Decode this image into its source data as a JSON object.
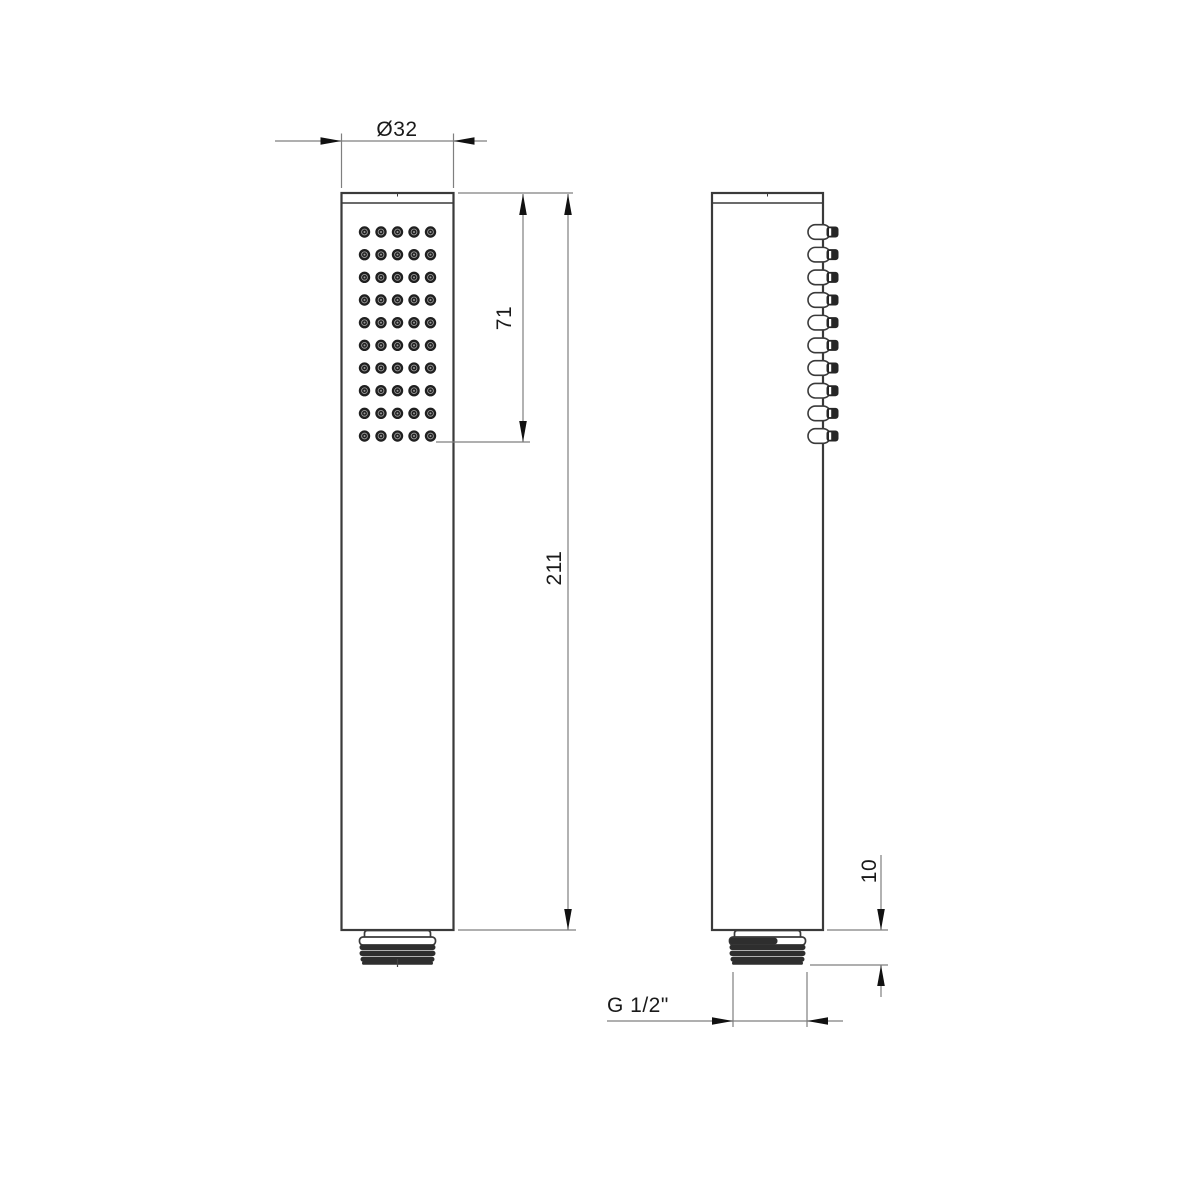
{
  "drawing": {
    "type": "technical-drawing",
    "labels": {
      "diameter": "Ø32",
      "nozzle_zone_height": "71",
      "overall_length": "211",
      "thread_length": "10",
      "thread_size": "G 1/2\""
    },
    "dimensions_mm": {
      "head_diameter": 32,
      "nozzle_zone_height": 71,
      "overall_length": 211,
      "thread_length": 10,
      "connection_thread": "G 1/2\""
    },
    "nozzle_grid": {
      "rows": 10,
      "columns": 5
    },
    "side_nozzle_count": 10,
    "colors": {
      "background": "#ffffff",
      "outline": "#3a3a3a",
      "dimension_line": "#7f7f7f",
      "arrow": "#111111",
      "text": "#1a1a1a",
      "nozzle": "#1f1f1f",
      "ridge": "#2e2e2e"
    }
  }
}
